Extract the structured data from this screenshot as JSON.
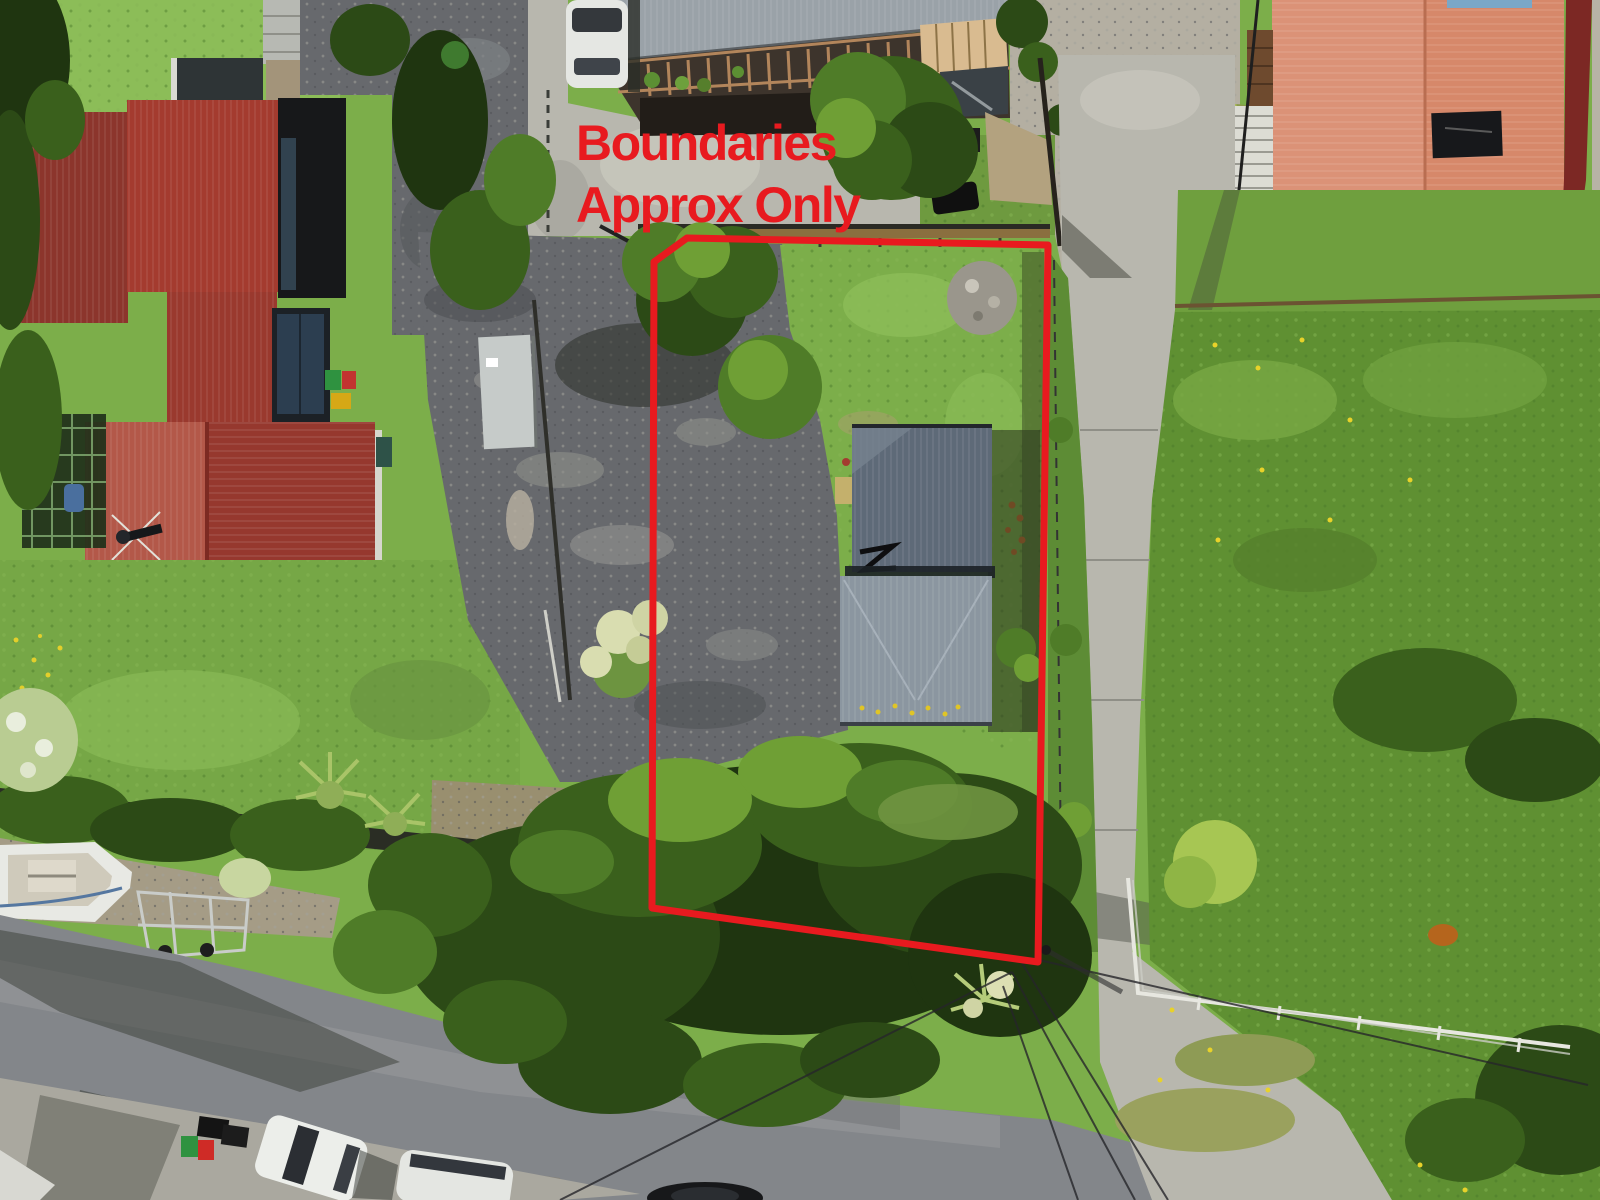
{
  "overlay": {
    "line1": "Boundaries",
    "line2": "Approx Only",
    "color": "#e81a1f",
    "boundary_stroke_width": 7
  },
  "palette": {
    "annotation_red": "#e81a1f",
    "left_house_roof_red": "#a43b2f",
    "lower_house_roof_red": "#b35849",
    "subject_house_roof_upper": "#5e6a78",
    "subject_house_roof_lower": "#8b96a0",
    "neighbour_roof_salmon": "#d6886a",
    "pergola_roof_grey": "#9aa2a8",
    "road_asphalt": "#83868a",
    "concrete": "#b8b7ae",
    "gravel": "#67696d",
    "lawn_green": "#7cae4a",
    "tree_dark_green": "#1f3510",
    "field_green": "#5f9032"
  }
}
